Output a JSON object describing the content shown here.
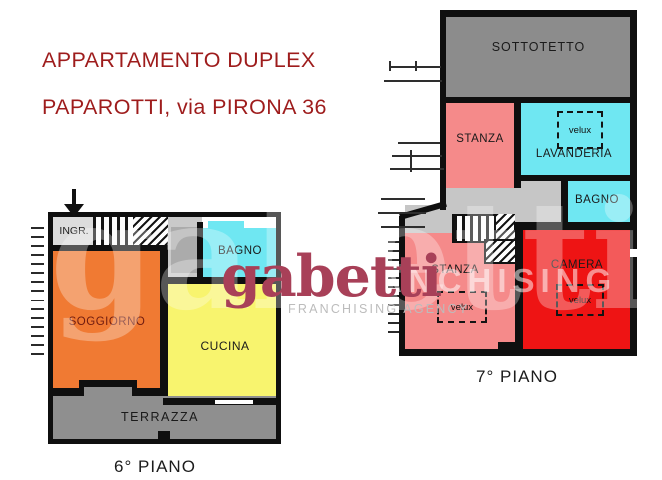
{
  "title": {
    "line1": "APPARTAMENTO DUPLEX",
    "line2": "PAPAROTTI, via PIRONA 36"
  },
  "branding": {
    "logo": "gabetti",
    "tagline": "FRANCHISING AGENCY",
    "ghost_text": "gabetti",
    "overlay_text": "ANCHISING"
  },
  "upper_floor": {
    "name": "7° PIANO",
    "rooms": {
      "sottotetto": {
        "label": "SOTTOTETTO",
        "color": "#8C8C8C"
      },
      "stanza_top": {
        "label": "STANZA",
        "color": "#F58A8A"
      },
      "lavanderia": {
        "label": "LAVANDERIA",
        "color": "#6FE7F2",
        "velux": "velux"
      },
      "bagno": {
        "label": "BAGNO",
        "color": "#6FE7F2"
      },
      "stanza_bottom": {
        "label": "STANZA",
        "color": "#F58A8A",
        "velux": "velux"
      },
      "camera": {
        "label": "CAMERA",
        "color": "#EE1414",
        "velux": "velux"
      }
    },
    "corridor_color": "#C6C6C6"
  },
  "lower_floor": {
    "name": "6° PIANO",
    "rooms": {
      "ingresso": {
        "label": "INGR.",
        "color": "#DCDCDC"
      },
      "bagno": {
        "label": "BAGNO",
        "color": "#6FE7F2"
      },
      "soggiorno": {
        "label": "SOGGIORNO",
        "color": "#F07A33"
      },
      "cucina": {
        "label": "CUCINA",
        "color": "#F8F46E"
      },
      "terrazza": {
        "label": "TERRAZZA",
        "color": "#8F8F8F"
      }
    },
    "landing_color": "#C9C9C9",
    "landing_inner_color": "#ABABAB"
  },
  "colors": {
    "title": "#9E1C1C",
    "logo": "#A84058",
    "tagline": "#BCBCBC",
    "wall": "#0F0F0F"
  }
}
